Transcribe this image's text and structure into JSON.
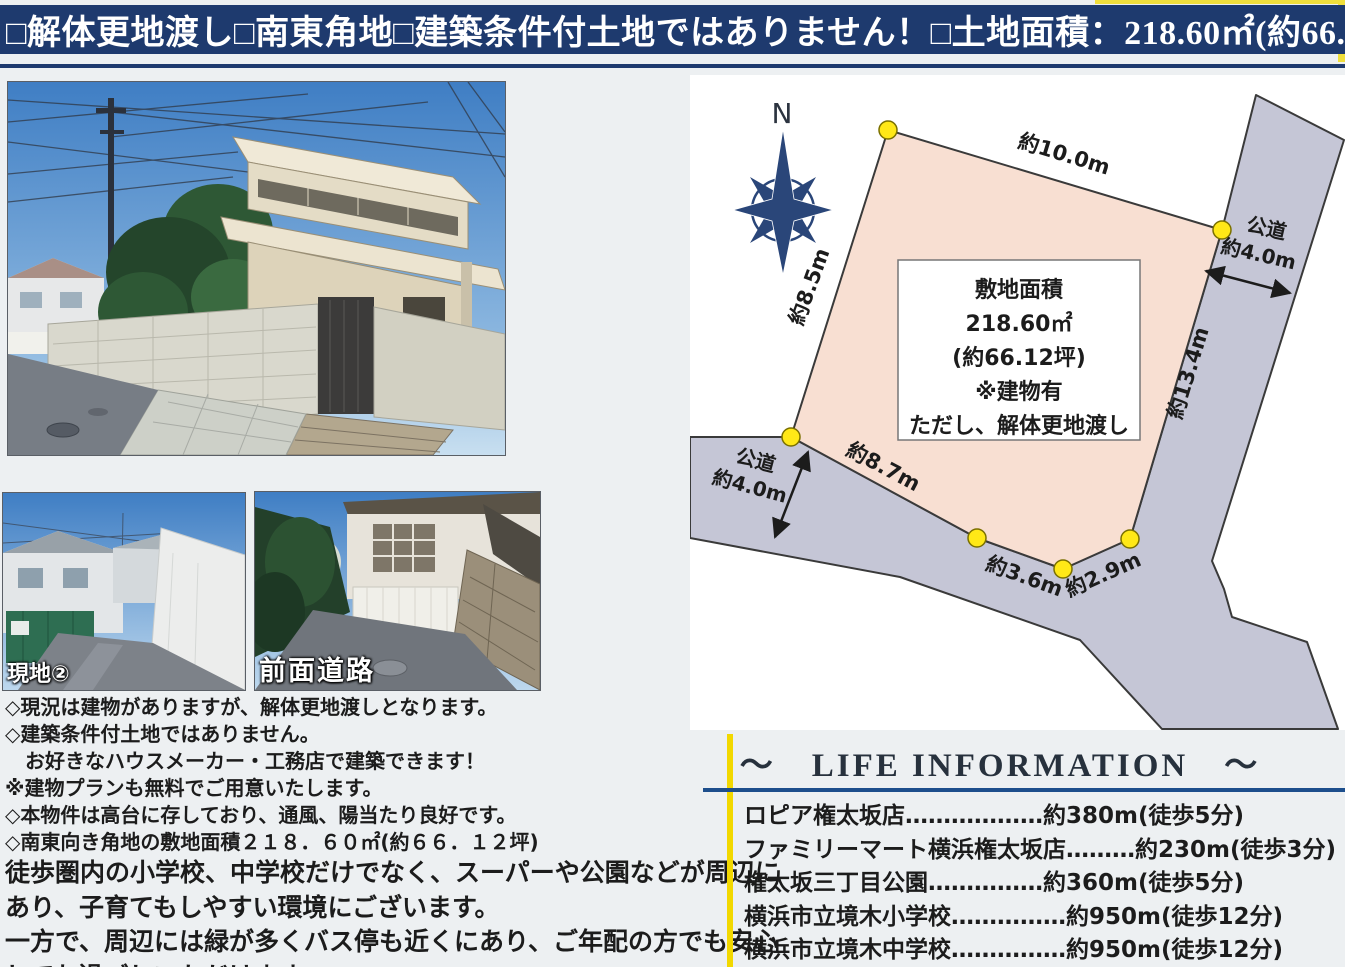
{
  "banner": {
    "items": [
      "□解体更地渡し",
      "□南東角地",
      "□建築条件付土地ではありません！",
      "□土地面積：218.60㎡(約66.12坪)"
    ]
  },
  "photos": {
    "site2_label": "現地②",
    "front_road_label": "前面道路"
  },
  "diagram": {
    "north": "N",
    "edge_labels": {
      "top": "約10.0m",
      "left": "約8.5m",
      "right": "約13.4m",
      "bottom1": "約8.7m",
      "bottom2": "約3.6m",
      "bottom3": "約2.9m"
    },
    "road_right": {
      "name": "公道",
      "width": "約4.0m"
    },
    "road_left": {
      "name": "公道",
      "width": "約4.0m"
    },
    "center_box": {
      "line1": "敷地面積",
      "line2": "218.60㎡",
      "line3": "(約66.12坪)",
      "line4": "※建物有",
      "line5": "ただし、解体更地渡し"
    },
    "colors": {
      "plot": "#f8dfd2",
      "road": "#c5c6d6",
      "marker": "#ffe817",
      "outline": "#3a3a3a",
      "compass": "#2a4679"
    }
  },
  "notes": {
    "lines": [
      "◇現況は建物がありますが、解体更地渡しとなります。",
      "◇建築条件付土地ではありません。",
      "　お好きなハウスメーカー・工務店で建築できます！",
      "※建物プランも無料でご用意いたします。",
      "◇本物件は高台に存しており、通風、陽当たり良好です。",
      "◇南東向き角地の敷地面積２１８．６０㎡(約６６．１２坪)",
      "徒歩圏内の小学校、中学校だけでなく、スーパーや公園などが周辺に",
      "あり、子育てもしやすい環境にございます。",
      "一方で、周辺には緑が多くバス停も近くにあり、ご年配の方でも安心",
      "してお過ごしいただけます。"
    ]
  },
  "life_information": {
    "title": "～　LIFE INFORMATION　～",
    "items": [
      "ロピア権太坂店………………約380m(徒歩5分)",
      "ファミリーマート横浜権太坂店………約230m(徒歩3分)",
      "権太坂三丁目公園……………約360m(徒歩5分)",
      "横浜市立境木小学校……………約950m(徒歩12分)",
      "横浜市立境木中学校……………約950m(徒歩12分)"
    ]
  }
}
